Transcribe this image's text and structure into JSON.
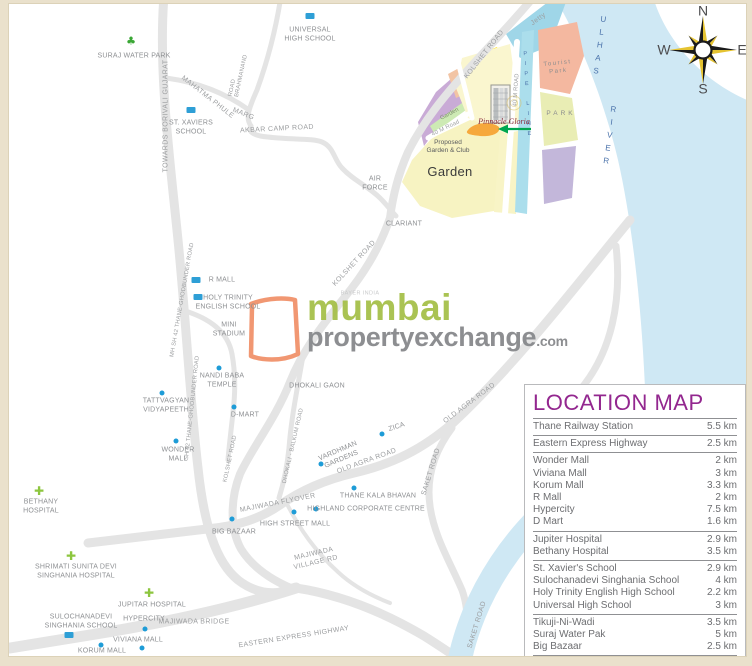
{
  "meta": {
    "kind": "property-location-map"
  },
  "compass": {
    "n": "N",
    "e": "E",
    "s": "S",
    "w": "W"
  },
  "watermark": {
    "line1": "mumbai",
    "line2": "propertyexchange",
    "suffix": ".com"
  },
  "project": {
    "name": "Pinnacle Gloria"
  },
  "colors": {
    "frame_beige": "#eae1cc",
    "water_blue": "#cfe8f4",
    "road_gray": "#e4e4e4",
    "title_purple": "#93278f",
    "brand_green": "#a6c04a",
    "brand_gray": "#87898c",
    "brand_orange": "#f1926b",
    "marker_blue": "#1e9cd7",
    "hospital_green": "#8dc63f",
    "arrow_green": "#00a650",
    "pipeline_blue": "#abdeec",
    "garden_yellow": "#f7f3c2",
    "park_green": "#e9edb4",
    "tourist_salmon": "#f4b8a0",
    "zone_purple": "#c9abd6",
    "jetty_cyan": "#9fd6e8",
    "highlight_yellow": "#ffe32a"
  },
  "legend": {
    "title": "LOCATION MAP",
    "footer": "(All distances are approximate)",
    "rows": [
      {
        "name": "Thane Railway Station",
        "km": "5.5 km"
      },
      {
        "name": "Eastern Express Highway",
        "km": "2.5 km"
      },
      {
        "name": "Wonder Mall",
        "km": "2 km"
      },
      {
        "name": "Viviana Mall",
        "km": "3 km"
      },
      {
        "name": "Korum Mall",
        "km": "3.3 km"
      },
      {
        "name": "R Mall",
        "km": "2 km"
      },
      {
        "name": "Hypercity",
        "km": "7.5 km"
      },
      {
        "name": "D Mart",
        "km": "1.6 km"
      },
      {
        "name": "Jupiter Hospital",
        "km": "2.9 km"
      },
      {
        "name": "Bethany Hospital",
        "km": "3.5 km"
      },
      {
        "name": "St. Xavier's School",
        "km": "2.9 km"
      },
      {
        "name": "Sulochanadevi Singhania School",
        "km": "4 km"
      },
      {
        "name": "Holy Trinity English High School",
        "km": "2.2 km"
      },
      {
        "name": "Universal High School",
        "km": "3 km"
      },
      {
        "name": "Tikuji-Ni-Wadi",
        "km": "3.5 km"
      },
      {
        "name": "Suraj Water Pak",
        "km": "5 km"
      },
      {
        "name": "Big Bazaar",
        "km": "2.5 km"
      }
    ]
  },
  "map": {
    "labels": {
      "suraj_water_park": "SURAJ WATER PARK",
      "universal_high_school": "UNIVERSAL\nHIGH SCHOOL",
      "towards_borivali": "TOWARDS BORIVALI GUJARAT",
      "mahatma_phule": "MAHATMA PHULE",
      "marg": "MARG",
      "brahmanand": "BRAHMANAND",
      "brahmanand_road": "ROAD",
      "st_xaviers": "ST. XAVIERS\nSCHOOL",
      "akbar_camp_road": "AKBAR CAMP ROAD",
      "air_force": "AIR\nFORCE",
      "clariant": "CLARIANT",
      "kolshet_road_top": "KOLSHET ROAD",
      "jetty": "Jetty",
      "ulhas": "ULHAS",
      "river": "RIVER",
      "tourist_park": "Tourist\nPark",
      "park": "PARK",
      "pipeline": "PIPE LINE",
      "forty_m_road_v": "40 M ROAD",
      "garden_strip": "Garden",
      "forty_m_road_d": "40 M Road",
      "proposed_garden": "Proposed\nGarden & Club",
      "garden_big": "Garden",
      "kolshet_road_mid": "KOLSHET ROAD",
      "bayer_india": "BAYER INDIA",
      "r_mall": "R MALL",
      "holy_trinity": "HOLY TRINITY\nENGLISH SCHOOL",
      "mini_stadium": "MINI\nSTADIUM",
      "nandi_baba": "NANDI BABA\nTEMPLE",
      "mh_sh42": "MH SH 42 THANE-GHODBUNDER ROAD",
      "sh42": "SH 42 THANE-GHODBUNDER ROAD",
      "tattvagyan": "TATTVAGYAN\nVIDYAPEETH",
      "d_mart": "D-MART",
      "dhokali_gaon": "DHOKALI GAON",
      "zica": "ZICA",
      "wonder_mall": "WONDER\nMALL",
      "kolshet_road_low": "KOLSHET ROAD",
      "old_agra_1": "OLD AGRA ROAD",
      "old_agra_2": "OLD AGRA ROAD",
      "dhokali_balkum": "DHOKALI - BALKUM ROAD",
      "vardhman": "VARDHMAN\nGARDENS",
      "bethany": "BETHANY\nHOSPITAL",
      "thane_kala": "THANE KALA BHAVAN",
      "highland": "HIGHLAND CORPORATE CENTRE",
      "high_street": "HIGH STREET MALL",
      "big_bazaar": "BIG BAZAAR",
      "majiwada_flyover": "MAJIWADA FLYOVER",
      "majiwada_village": "MAJIWADA\nVILLAGE RD",
      "saket_1": "SAKET ROAD",
      "saket_2": "SAKET ROAD",
      "shrimati": "SHRIMATI SUNITA DEVI\nSINGHANIA HOSPITAL",
      "jupitar": "JUPITAR HOSPITAL",
      "sulochanadevi": "SULOCHANADEVI\nSINGHANIA SCHOOL",
      "hypercity": "HYPERCITY",
      "majiwada_bridge": "MAJIWADA BRIDGE",
      "viviana": "VIVIANA MALL",
      "korum": "KORUM MALL",
      "eastern_express": "EASTERN EXPRESS HIGHWAY"
    }
  }
}
